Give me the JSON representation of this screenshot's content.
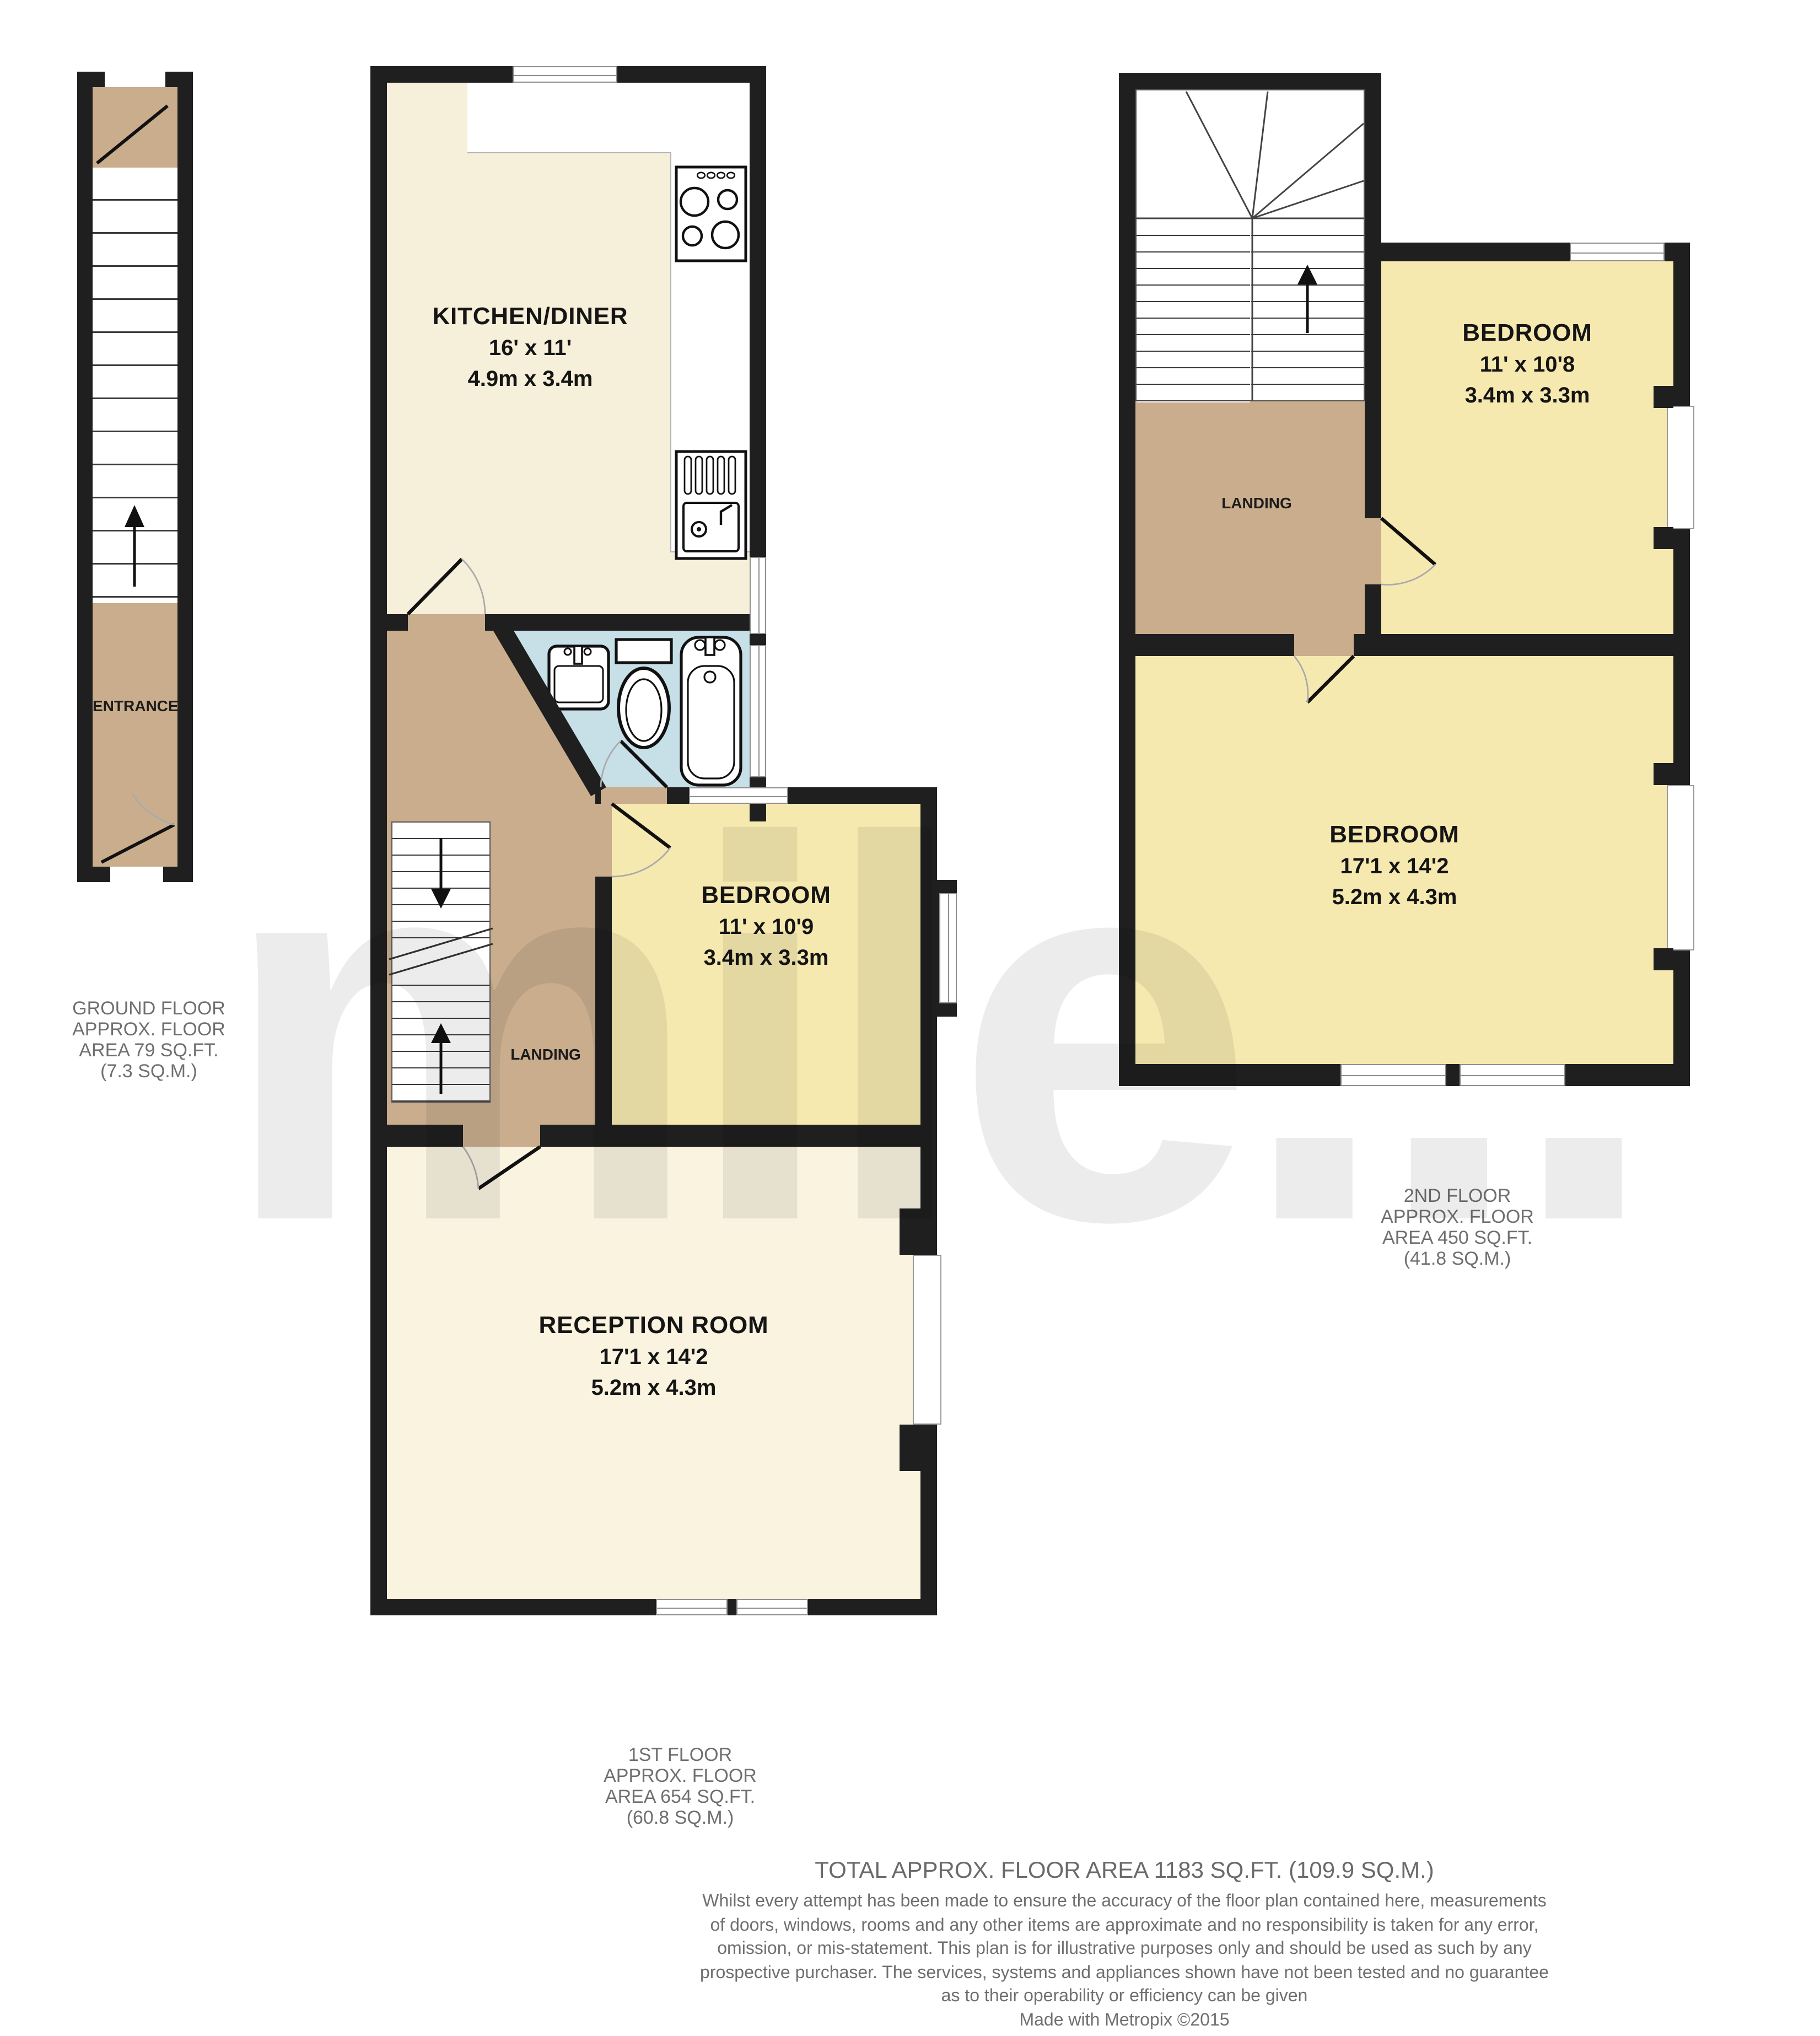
{
  "watermark": "mile...",
  "colors": {
    "wall": "#1f1f1f",
    "kitchen_floor": "#f6efd9",
    "reception_floor": "#f9f3df",
    "bedroom_floor": "#f6e9b0",
    "hall_floor": "#c9ad8d",
    "bathroom_floor": "#c7e0e7",
    "label_gray": "#6f6f6f"
  },
  "ground_floor": {
    "entrance_label": "ENTRANCE",
    "area_lines": [
      "GROUND FLOOR",
      "APPROX. FLOOR",
      "AREA 79 SQ.FT.",
      "(7.3 SQ.M.)"
    ]
  },
  "first_floor": {
    "kitchen": {
      "name": "KITCHEN/DINER",
      "dims_ft": "16' x 11'",
      "dims_m": "4.9m x 3.4m"
    },
    "bedroom": {
      "name": "BEDROOM",
      "dims_ft": "11' x 10'9",
      "dims_m": "3.4m x 3.3m"
    },
    "landing_label": "LANDING",
    "reception": {
      "name": "RECEPTION ROOM",
      "dims_ft": "17'1 x 14'2",
      "dims_m": "5.2m x 4.3m"
    },
    "area_lines": [
      "1ST FLOOR",
      "APPROX. FLOOR",
      "AREA 654 SQ.FT.",
      "(60.8 SQ.M.)"
    ]
  },
  "second_floor": {
    "bedroom_small": {
      "name": "BEDROOM",
      "dims_ft": "11' x 10'8",
      "dims_m": "3.4m x 3.3m"
    },
    "landing_label": "LANDING",
    "bedroom_large": {
      "name": "BEDROOM",
      "dims_ft": "17'1 x 14'2",
      "dims_m": "5.2m x 4.3m"
    },
    "area_lines": [
      "2ND FLOOR",
      "APPROX. FLOOR",
      "AREA 450 SQ.FT.",
      "(41.8 SQ.M.)"
    ]
  },
  "footer": {
    "total": "TOTAL APPROX. FLOOR AREA 1183 SQ.FT. (109.9 SQ.M.)",
    "disclaimer_lines": [
      "Whilst every attempt has been made to ensure the accuracy of the floor plan contained here, measurements",
      "of doors, windows, rooms and any other items are approximate and no responsibility is taken for any error,",
      "omission, or mis-statement. This plan is for illustrative purposes only and should be used as such by any",
      "prospective purchaser. The services, systems and appliances shown have not been tested and no guarantee",
      "as to their operability or efficiency can be given"
    ],
    "credit": "Made with Metropix ©2015"
  }
}
